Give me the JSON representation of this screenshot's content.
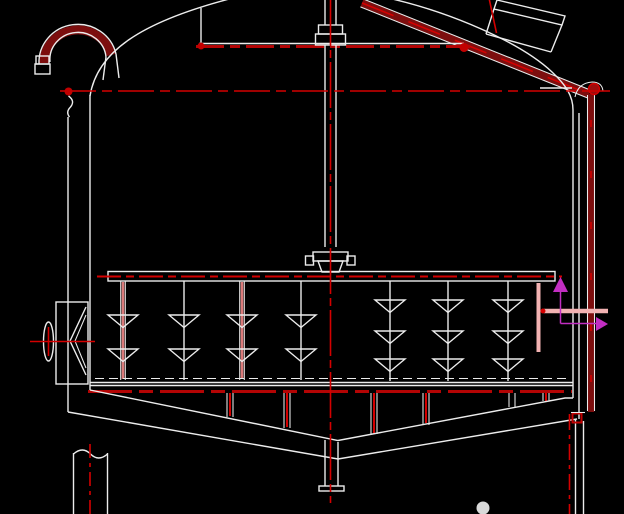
{
  "meta": {
    "title": "CAD elevation drawing: agitated rake tank with false bottom and cone discharge",
    "canvas": {
      "width": 624,
      "height": 514
    }
  },
  "palette": {
    "background": "#000000",
    "line_white": "#ececec",
    "centerline_red": "#d40000",
    "beam_dark_red": "#b40404",
    "pipe_fill_dark_red": "#7c0e0e",
    "rod_red": "#db7a7a",
    "highlight_pink": "#f2b2b2",
    "annotation_magenta": "#c22ec2",
    "watermark_gray": "#d9d9d9"
  },
  "components": {
    "vent_swan_neck": "swan-neck vent pipe with end flange",
    "tank_head": "dished tank head",
    "manhole": "inclined manhole with lid on head",
    "feed_pipe": "inclined dark-red feed pipe",
    "downcomer": "vertical dark-red downpipe at right shell with elbow",
    "top_beam": "horizontal support beam across head",
    "agitator_shaft": "central agitator shaft with stuffing-box coupling",
    "shaft_hub": "bolted hub joining shaft to rake arm",
    "rake_arm": "horizontal rake arm",
    "tine_rods_left": "four tine rods with two chevron blades each (alternating red/white)",
    "tine_rods_right": "three tine rods with three chevron blades each",
    "highlighted_rod": "pink highlighted rod near right wall",
    "side_nozzle_left": "left side nozzle box with cone and handwheel",
    "side_outlet_pink": "pink highlighted side outlet nozzle through right wall",
    "flow_arrows": "magenta flow-direction arrows (up, then right)",
    "false_bottom": "perforated false-bottom plate with red underline",
    "plate_supports": "short support posts between plate and cone",
    "cone_bottom": "double-wall V cone discharge bottom",
    "outlet_nozzle": "bottom center outlet pipe with flange",
    "support_leg_left": "left support leg shown with break line",
    "support_leg_right": "right support leg with red service line and valve fitting",
    "watermark_dot": "light gray dot artifact near bottom"
  }
}
